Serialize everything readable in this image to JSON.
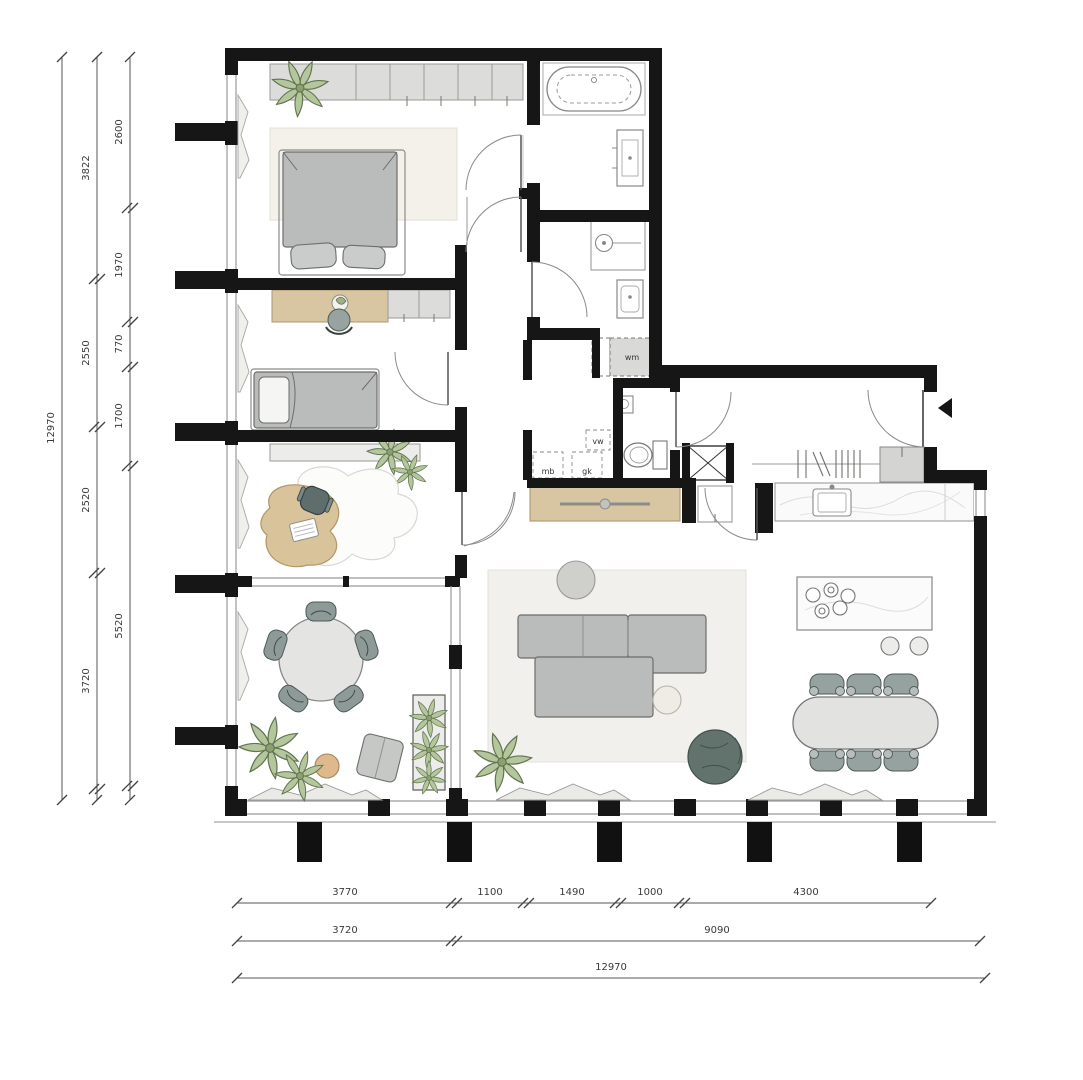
{
  "drawing": {
    "type": "apartment-floor-plan",
    "fixture_labels": {
      "washing_machine": "wm",
      "dishwasher": "vw",
      "mb": "mb",
      "gk": "gk"
    },
    "colors": {
      "wall": "#161616",
      "wood": "#d8c6a2",
      "furniture_gray": "#b9bcba",
      "wardrobe_gray": "#dcdcda",
      "plant_green": "#b4c69c",
      "dark_plant": "#62736e",
      "marble": "#fafafa",
      "dimension_text": "#3a3a3a"
    }
  },
  "dimensions": {
    "left_inner": [
      "2600",
      "1970",
      "770",
      "1700",
      "5520"
    ],
    "left_middle": [
      "3822",
      "2550",
      "2520",
      "3720"
    ],
    "left_total": "12970",
    "bottom_row1": [
      "3770",
      "1100",
      "1490",
      "1000",
      "4300"
    ],
    "bottom_row2": [
      "3720",
      "9090"
    ],
    "bottom_total": "12970"
  }
}
